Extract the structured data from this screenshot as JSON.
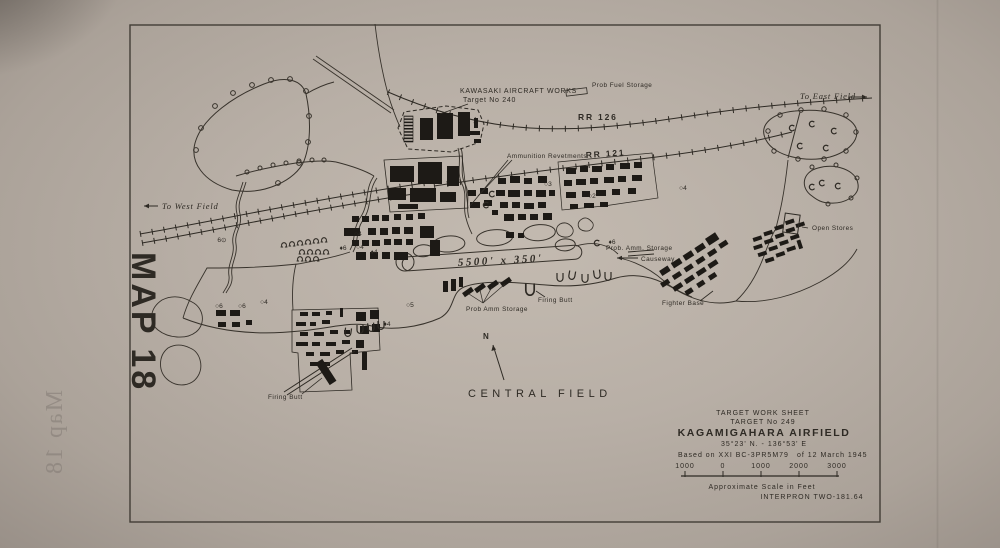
{
  "colors": {
    "paper": "#b8afa6",
    "ink": "#2e2a24",
    "building": "#1d1a16",
    "bleed_text": "#7d7570"
  },
  "map": {
    "side_label": "MAP 18",
    "bleed_label": "Map 18",
    "labels": {
      "kawasaki_1": "KAWASAKI AIRCRAFT WORKS",
      "kawasaki_2": "Target No 240",
      "prob_fuel_storage": "Prob Fuel Storage",
      "to_east_field": "To East Field",
      "to_west_field": "To West Field",
      "rr_126": "RR 126",
      "rr_121": "RR 121",
      "ammunition_revetments": "Ammunition Revetments",
      "open_stores": "Open Stores",
      "prob_amm_storage_north": "Prob. Amm. Storage",
      "causeway": "Causeway",
      "runway_dimensions": "5500' x 350'",
      "prob_amm_storage_south": "Prob Amm Storage",
      "firing_butt_east": "Firing Butt",
      "firing_butt_west": "Firing Butt",
      "fighter_base": "Fighter Base",
      "central_field": "CENTRAL FIELD",
      "north_indicator": "N"
    },
    "markers": [
      {
        "text": "6⊙"
      },
      {
        "text": "○6"
      },
      {
        "text": "○6"
      },
      {
        "text": "○4"
      },
      {
        "text": "○4"
      },
      {
        "text": "♦6"
      },
      {
        "text": "○4"
      },
      {
        "text": "♦4"
      },
      {
        "text": "○3"
      },
      {
        "text": "○2"
      },
      {
        "text": "○4"
      },
      {
        "text": "♦6"
      },
      {
        "text": "○5"
      },
      {
        "text": "♦4"
      }
    ],
    "title_block": {
      "line1": "TARGET WORK SHEET",
      "line2": "TARGET No 249",
      "line3": "KAGAMIGAHARA AIRFIELD",
      "line4": "35°23' N. - 136°53' E",
      "based_on": "Based on XXI BC-3PR5M79",
      "date": "of 12 March 1945",
      "scale_ticks": [
        "1000",
        "0",
        "1000",
        "2000",
        "3000"
      ],
      "scale_caption": "Approximate Scale in Feet",
      "credit": "INTERPRON TWO-181.64"
    }
  }
}
